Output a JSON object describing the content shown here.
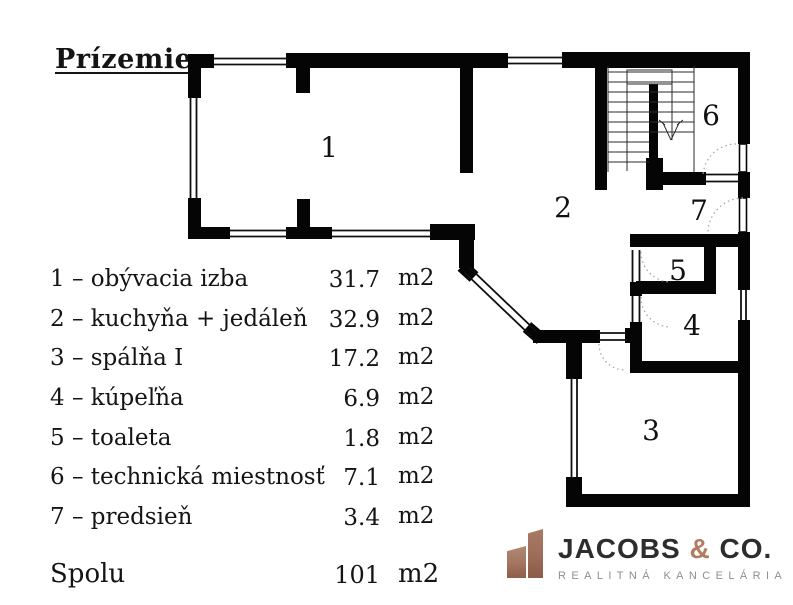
{
  "title": "Prízemie",
  "plan": {
    "room_numbers": [
      "1",
      "2",
      "3",
      "4",
      "5",
      "6",
      "7"
    ]
  },
  "legend": {
    "rows": [
      {
        "label": "1 – obývacia izba",
        "area": "31.7",
        "unit": "m2"
      },
      {
        "label": "2 – kuchyňa + jedáleň",
        "area": "32.9",
        "unit": "m2"
      },
      {
        "label": "3 – spálňa I",
        "area": "17.2",
        "unit": "m2"
      },
      {
        "label": "4 – kúpeľňa",
        "area": "6.9",
        "unit": "m2"
      },
      {
        "label": "5 – toaleta",
        "area": "1.8",
        "unit": "m2"
      },
      {
        "label": "6 – technická miestnosť",
        "area": "7.1",
        "unit": "m2"
      },
      {
        "label": "7 – predsieň",
        "area": "3.4",
        "unit": "m2"
      }
    ],
    "total": {
      "label": "Spolu",
      "area": "101",
      "unit": "m2"
    }
  },
  "logo": {
    "brand_primary": "JACOBS ",
    "brand_amp": "&",
    "brand_secondary": " CO.",
    "subtitle": "REALITNÁ KANCELÁRIA",
    "accent_color": "#b27b62"
  }
}
